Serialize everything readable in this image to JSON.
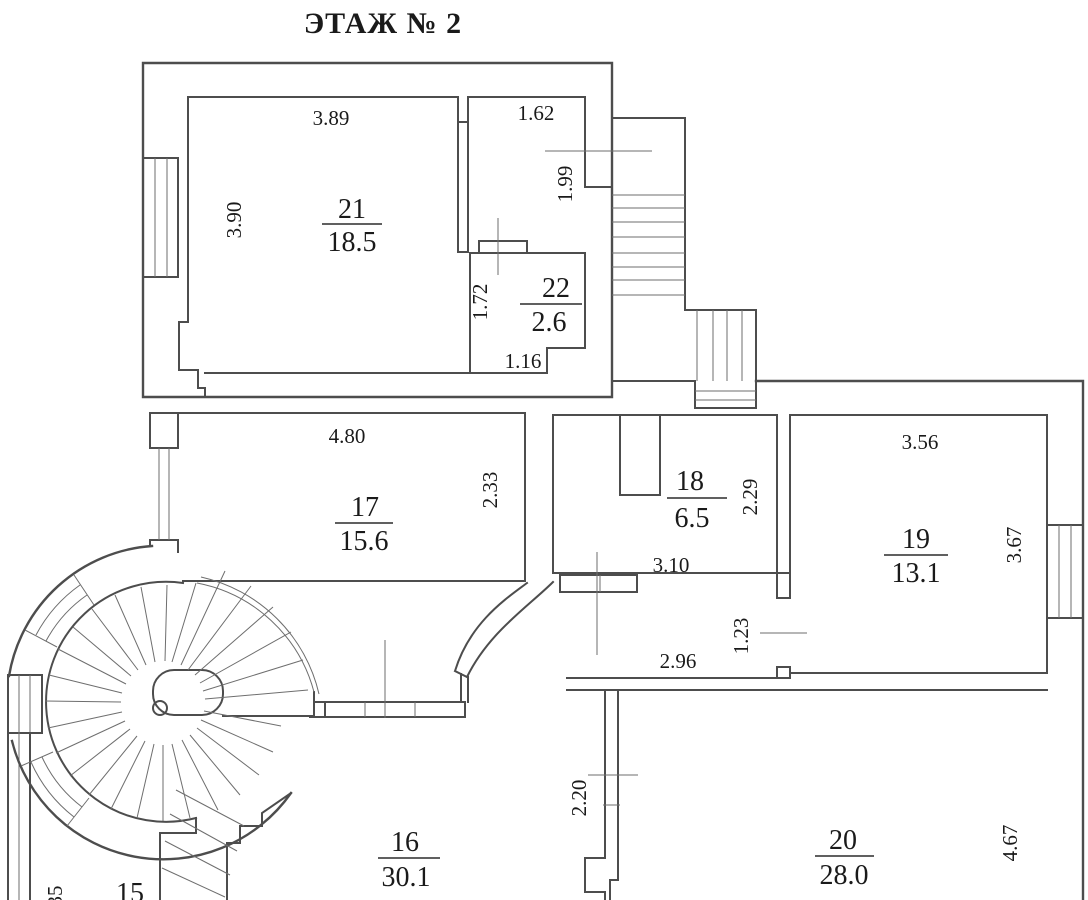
{
  "title": "ЭТАЖ № 2",
  "rooms": {
    "r15": {
      "number": "15"
    },
    "r16": {
      "number": "16",
      "area": "30.1"
    },
    "r17": {
      "number": "17",
      "area": "15.6",
      "dim_width": "4.80",
      "dim_height": "2.33"
    },
    "r18": {
      "number": "18",
      "area": "6.5",
      "dim_width": "3.10",
      "dim_height": "2.29"
    },
    "r19": {
      "number": "19",
      "area": "13.1",
      "dim_width": "3.56",
      "dim_height": "3.67"
    },
    "r20": {
      "number": "20",
      "area": "28.0",
      "dim_height": "4.67"
    },
    "r21": {
      "number": "21",
      "area": "18.5",
      "dim_width": "3.89",
      "dim_height": "3.90"
    },
    "r22": {
      "number": "22",
      "area": "2.6",
      "dim_height": "1.72",
      "dim_width": "1.16"
    }
  },
  "dimensions": {
    "entry_width": "1.62",
    "entry_height": "1.99",
    "hall_width": "2.96",
    "door_height": "1.23",
    "wall_16_20_height": "2.20",
    "left_edge_partial": "35"
  }
}
